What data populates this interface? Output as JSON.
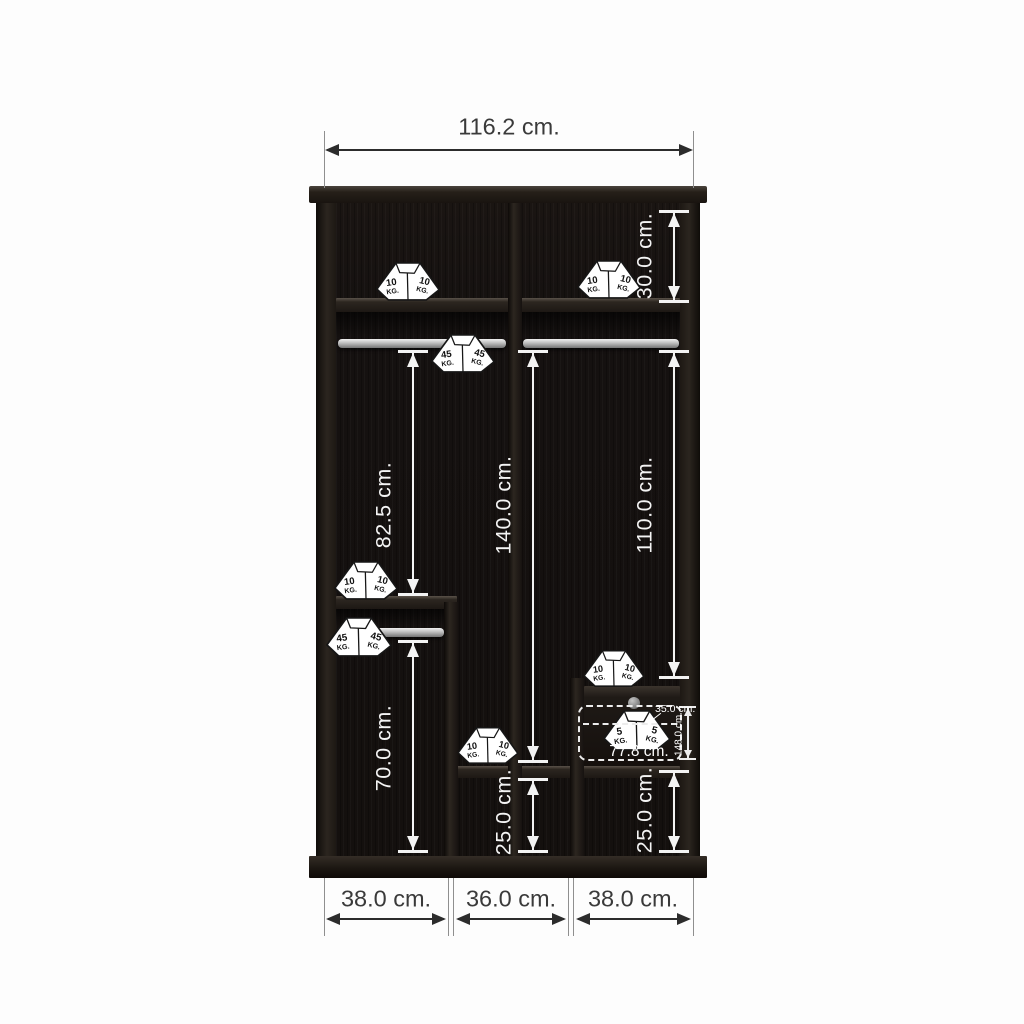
{
  "diagram": {
    "kind": "wardrobe-interior-dimension-diagram",
    "unit": "cm.",
    "weight_unit": "KG."
  },
  "dimensions": {
    "horizontal": [
      {
        "id": "overall-width",
        "label": "116.2 cm.",
        "x1": 325,
        "x2": 693,
        "y": 150,
        "label_cx": 509,
        "label_cy": 127
      },
      {
        "id": "bottom-left-section",
        "label": "38.0 cm.",
        "x1": 326,
        "x2": 446,
        "y": 919,
        "label_cx": 386,
        "label_cy": 899
      },
      {
        "id": "bottom-middle-section",
        "label": "36.0 cm.",
        "x1": 456,
        "x2": 566,
        "y": 919,
        "label_cx": 511,
        "label_cy": 899
      },
      {
        "id": "bottom-right-section",
        "label": "38.0 cm.",
        "x1": 576,
        "x2": 691,
        "y": 919,
        "label_cx": 633,
        "label_cy": 899
      }
    ],
    "extension_lines": [
      {
        "x": 324,
        "y": 131,
        "h": 57
      },
      {
        "x": 693,
        "y": 131,
        "h": 57
      },
      {
        "x": 324,
        "y": 878,
        "h": 58
      },
      {
        "x": 448,
        "y": 878,
        "h": 58
      },
      {
        "x": 453,
        "y": 878,
        "h": 58
      },
      {
        "x": 568,
        "y": 878,
        "h": 58
      },
      {
        "x": 573,
        "y": 878,
        "h": 58
      },
      {
        "x": 693,
        "y": 878,
        "h": 58
      }
    ],
    "vertical": [
      {
        "id": "top-shelf-space",
        "label": "30.0 cm.",
        "x": 674,
        "y1": 210,
        "y2": 303,
        "label_cy": 256
      },
      {
        "id": "left-rod-to-shelf",
        "label": "82.5 cm.",
        "x": 413,
        "y1": 350,
        "y2": 596,
        "label_cy": 505
      },
      {
        "id": "center-rod-to-bottom-shelf",
        "label": "140.0 cm.",
        "x": 533,
        "y1": 350,
        "y2": 763,
        "label_cy": 505
      },
      {
        "id": "right-rod-to-drawer",
        "label": "110.0 cm.",
        "x": 674,
        "y1": 350,
        "y2": 679,
        "label_cy": 505
      },
      {
        "id": "left-lower-space",
        "label": "70.0 cm.",
        "x": 413,
        "y1": 640,
        "y2": 853,
        "label_cy": 748
      },
      {
        "id": "middle-bottom-space",
        "label": "25.0 cm.",
        "x": 533,
        "y1": 778,
        "y2": 853,
        "label_cy": 812
      },
      {
        "id": "right-bottom-space",
        "label": "25.0 cm.",
        "x": 674,
        "y1": 770,
        "y2": 853,
        "label_cy": 810
      }
    ]
  },
  "drawer_annotation": {
    "depth_label": "35.0 cm.",
    "height_label": "148.0 cm.",
    "width_label": "77.8 cm."
  },
  "weight_icons": [
    {
      "id": "top-shelf-left",
      "capacity": "10",
      "x": 408,
      "y": 302,
      "w": 66
    },
    {
      "id": "top-shelf-right",
      "capacity": "10",
      "x": 609,
      "y": 300,
      "w": 66
    },
    {
      "id": "top-rod",
      "capacity": "45",
      "x": 463,
      "y": 374,
      "w": 66
    },
    {
      "id": "left-shelf",
      "capacity": "10",
      "x": 366,
      "y": 601,
      "w": 66
    },
    {
      "id": "left-rod",
      "capacity": "45",
      "x": 359,
      "y": 658,
      "w": 68
    },
    {
      "id": "middle-bottom-shelf",
      "capacity": "10",
      "x": 488,
      "y": 765,
      "w": 64
    },
    {
      "id": "drawer-top",
      "capacity": "10",
      "x": 614,
      "y": 688,
      "w": 64
    },
    {
      "id": "drawer-inside",
      "capacity": "5",
      "x": 637,
      "y": 752,
      "w": 70
    }
  ],
  "colors": {
    "wood_dark": "#15110e",
    "rod_gray": "#bdbdbd",
    "annotation_white": "#f3f3f3",
    "dimension_dark": "#2c2c2c"
  }
}
